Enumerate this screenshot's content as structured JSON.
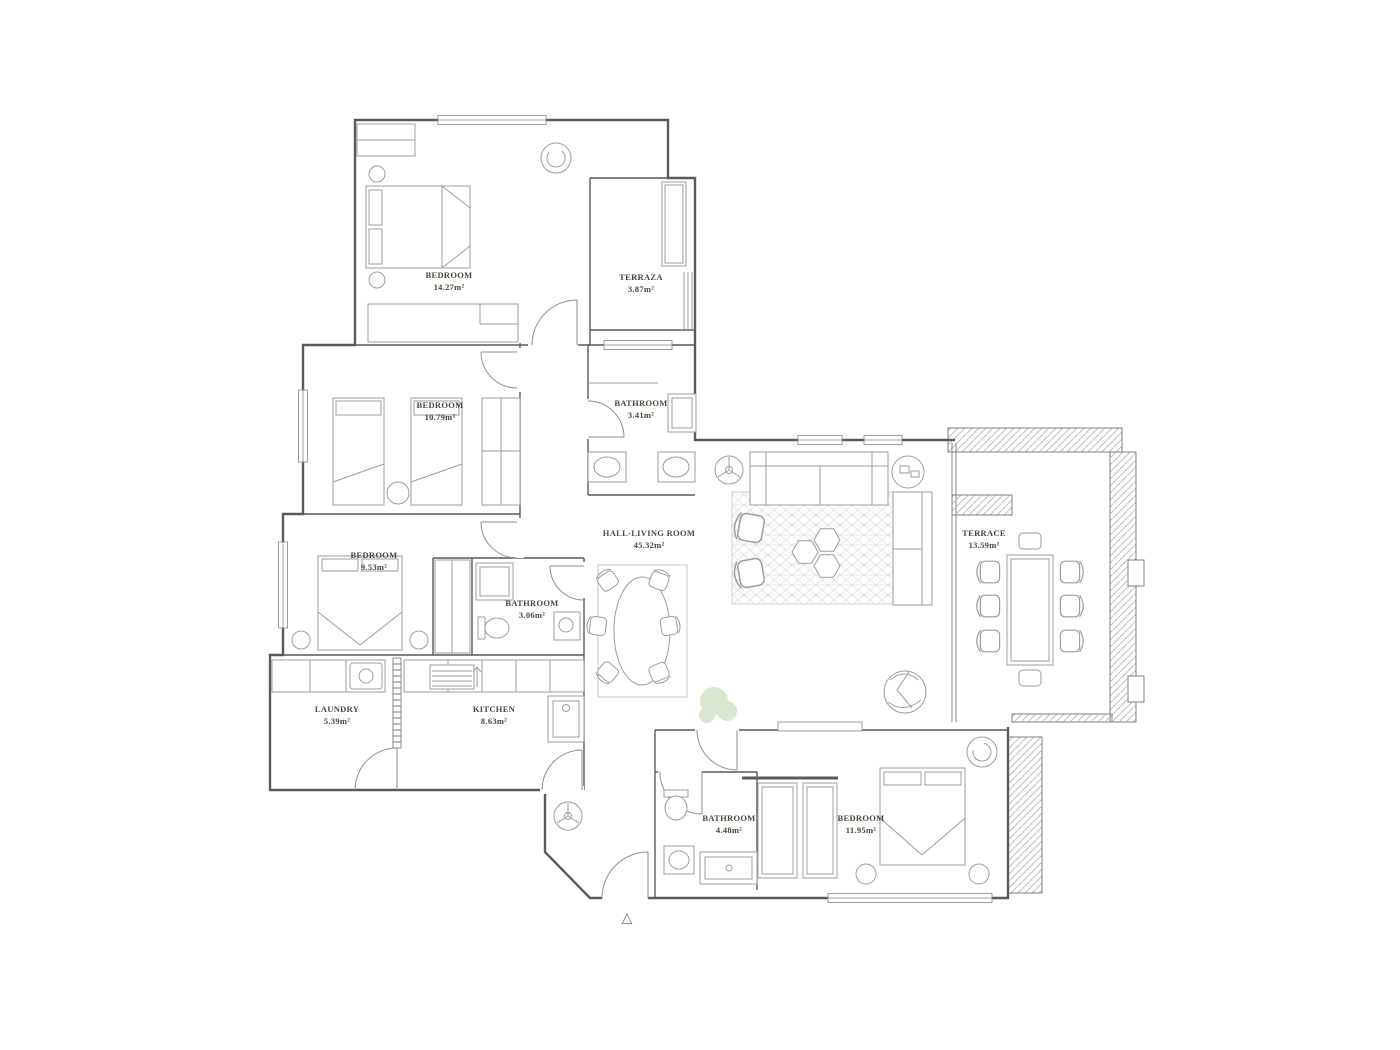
{
  "title": "Apartment floor plan",
  "rooms": [
    {
      "id": "bedroom-1",
      "name": "BEDROOM",
      "area": "14.27m²"
    },
    {
      "id": "terraza",
      "name": "TERRAZA",
      "area": "3.87m²"
    },
    {
      "id": "bedroom-2",
      "name": "BEDROOM",
      "area": "10.79m²"
    },
    {
      "id": "bathroom-1",
      "name": "BATHROOM",
      "area": "3.41m²"
    },
    {
      "id": "hall-living-room",
      "name": "HALL-LIVING ROOM",
      "area": "45.32m²"
    },
    {
      "id": "bedroom-3",
      "name": "BEDROOM",
      "area": "9.53m²"
    },
    {
      "id": "bathroom-2",
      "name": "BATHROOM",
      "area": "3.06m²"
    },
    {
      "id": "laundry",
      "name": "LAUNDRY",
      "area": "5.39m²"
    },
    {
      "id": "kitchen",
      "name": "KITCHEN",
      "area": "8.63m²"
    },
    {
      "id": "terrace",
      "name": "TERRACE",
      "area": "13.59m²"
    },
    {
      "id": "bathroom-3",
      "name": "BATHROOM",
      "area": "4.48m²"
    },
    {
      "id": "bedroom-4",
      "name": "BEDROOM",
      "area": "11.95m²"
    }
  ],
  "symbols": {
    "north_arrow": "△"
  },
  "colors": {
    "walls": "#5a5a5a",
    "furniture": "#9d9d9d",
    "labels": "#4b473d",
    "hatch": "#b2b2b2",
    "plant_green": "#bfd3ad"
  }
}
